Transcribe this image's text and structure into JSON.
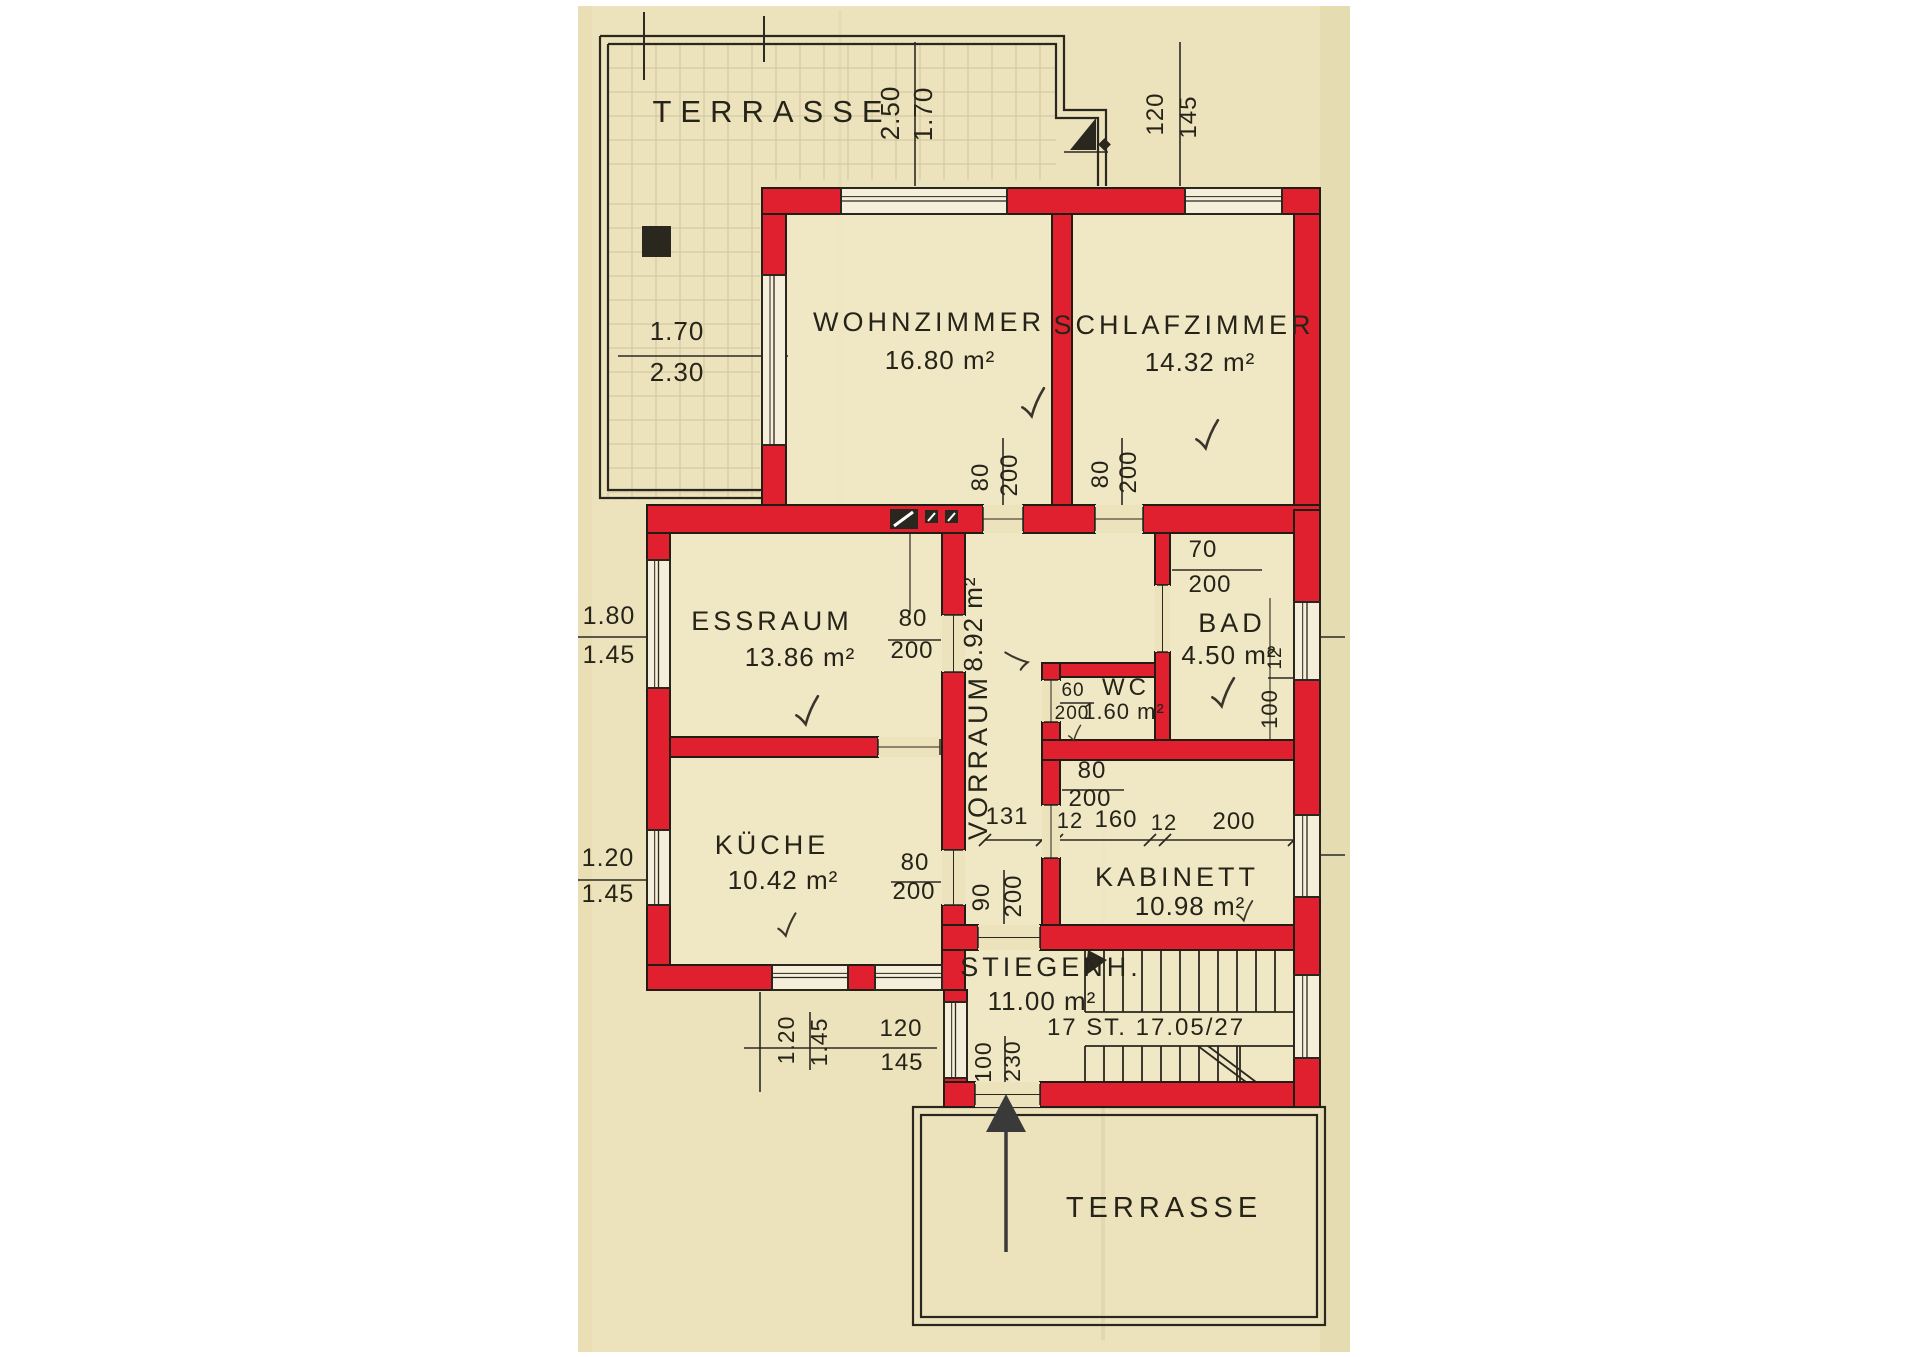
{
  "palette": {
    "paper": "#ece2bb",
    "paper_edge": "#e0d4a6",
    "floor": "#f1e8c8",
    "ink": "#2a271f",
    "wall_red": "#e0202f",
    "wall_outline": "#211d15",
    "grid": "#b4a87e",
    "window_fill": "#f4eeda"
  },
  "rooms": [
    {
      "id": "terrasse-top",
      "name": "TERRASSE",
      "area": "",
      "cx": 772,
      "cy": 122,
      "size": 31,
      "ls": 9
    },
    {
      "id": "wohnzimmer",
      "name": "WOHNZIMMER",
      "area": "16.80 m²",
      "cx": 929,
      "cy": 331,
      "acx": 940,
      "acy": 369
    },
    {
      "id": "schlafzimmer",
      "name": "SCHLAFZIMMER",
      "area": "14.32 m²",
      "cx": 1184,
      "cy": 334,
      "acx": 1200,
      "acy": 371
    },
    {
      "id": "essraum",
      "name": "ESSRAUM",
      "area": "13.86 m²",
      "cx": 772,
      "cy": 630,
      "acx": 800,
      "acy": 666
    },
    {
      "id": "vorraum",
      "name": "VORRAUM",
      "area": "8.92 m²",
      "cx": 987,
      "cy": 757,
      "acx": 982,
      "acy": 624,
      "rot": -90
    },
    {
      "id": "bad",
      "name": "BAD",
      "area": "4.50 m²",
      "cx": 1232,
      "cy": 632,
      "acx": 1229,
      "acy": 664
    },
    {
      "id": "wc",
      "name": "WC",
      "area": "1.60 m²",
      "cx": 1126,
      "cy": 695,
      "acx": 1124,
      "acy": 719,
      "size": 24,
      "asize": 22
    },
    {
      "id": "kueche",
      "name": "KÜCHE",
      "area": "10.42 m²",
      "cx": 772,
      "cy": 854,
      "acx": 783,
      "acy": 889
    },
    {
      "id": "kabinett",
      "name": "KABINETT",
      "area": "10.98 m²",
      "cx": 1177,
      "cy": 886,
      "acx": 1190,
      "acy": 915
    },
    {
      "id": "stiegenhaus",
      "name": "STIEGENH.",
      "area": "11.00 m²",
      "cx": 1051,
      "cy": 976,
      "acx": 1042,
      "acy": 1010,
      "note": "17 ST. 17.05/27",
      "ncx": 1146,
      "ncy": 1035
    },
    {
      "id": "terrasse-bottom",
      "name": "TERRASSE",
      "area": "",
      "cx": 1164,
      "cy": 1217,
      "size": 29,
      "ls": 5
    }
  ],
  "dims": [
    {
      "t": "2.50",
      "x": 899,
      "y": 113,
      "r": -90,
      "s": 26
    },
    {
      "t": "1.70",
      "x": 932,
      "y": 114,
      "r": -90,
      "s": 26
    },
    {
      "t": "120",
      "x": 1163,
      "y": 114,
      "r": -90,
      "s": 24
    },
    {
      "t": "145",
      "x": 1196,
      "y": 117,
      "r": -90,
      "s": 24
    },
    {
      "t": "1.70",
      "x": 677,
      "y": 340,
      "r": 0,
      "s": 26
    },
    {
      "t": "2.30",
      "x": 677,
      "y": 381,
      "r": 0,
      "s": 26
    },
    {
      "t": "80",
      "x": 988,
      "y": 477,
      "r": -90,
      "s": 24
    },
    {
      "t": "200",
      "x": 1017,
      "y": 475,
      "r": -90,
      "s": 24
    },
    {
      "t": "80",
      "x": 1108,
      "y": 474,
      "r": -90,
      "s": 24
    },
    {
      "t": "200",
      "x": 1136,
      "y": 472,
      "r": -90,
      "s": 24
    },
    {
      "t": "70",
      "x": 1203,
      "y": 557,
      "r": 0,
      "s": 24
    },
    {
      "t": "200",
      "x": 1210,
      "y": 592,
      "r": 0,
      "s": 24
    },
    {
      "t": "1.80",
      "x": 609,
      "y": 624,
      "r": 0,
      "s": 25
    },
    {
      "t": "1.45",
      "x": 609,
      "y": 663,
      "r": 0,
      "s": 25
    },
    {
      "t": "80",
      "x": 913,
      "y": 626,
      "r": 0,
      "s": 24
    },
    {
      "t": "200",
      "x": 912,
      "y": 658,
      "r": 0,
      "s": 24
    },
    {
      "t": "60",
      "x": 1073,
      "y": 696,
      "r": 0,
      "s": 19
    },
    {
      "t": "200",
      "x": 1072,
      "y": 719,
      "r": 0,
      "s": 19
    },
    {
      "t": "12",
      "x": 1281,
      "y": 658,
      "r": -90,
      "s": 19
    },
    {
      "t": "100",
      "x": 1277,
      "y": 709,
      "r": -90,
      "s": 22
    },
    {
      "t": "1.20",
      "x": 608,
      "y": 866,
      "r": 0,
      "s": 25
    },
    {
      "t": "1.45",
      "x": 608,
      "y": 902,
      "r": 0,
      "s": 25
    },
    {
      "t": "80",
      "x": 915,
      "y": 870,
      "r": 0,
      "s": 24
    },
    {
      "t": "200",
      "x": 914,
      "y": 899,
      "r": 0,
      "s": 24
    },
    {
      "t": "90",
      "x": 989,
      "y": 897,
      "r": -90,
      "s": 24
    },
    {
      "t": "200",
      "x": 1021,
      "y": 896,
      "r": -90,
      "s": 24
    },
    {
      "t": "80",
      "x": 1092,
      "y": 778,
      "r": 0,
      "s": 24
    },
    {
      "t": "200",
      "x": 1090,
      "y": 806,
      "r": 0,
      "s": 24
    },
    {
      "t": "131",
      "x": 1007,
      "y": 824,
      "r": 0,
      "s": 24
    },
    {
      "t": "12",
      "x": 1070,
      "y": 828,
      "r": 0,
      "s": 22
    },
    {
      "t": "160",
      "x": 1116,
      "y": 827,
      "r": 0,
      "s": 24
    },
    {
      "t": "12",
      "x": 1164,
      "y": 830,
      "r": 0,
      "s": 22
    },
    {
      "t": "200",
      "x": 1234,
      "y": 829,
      "r": 0,
      "s": 24
    },
    {
      "t": "120",
      "x": 901,
      "y": 1036,
      "r": 0,
      "s": 24
    },
    {
      "t": "145",
      "x": 902,
      "y": 1070,
      "r": 0,
      "s": 24
    },
    {
      "t": "1.20",
      "x": 794,
      "y": 1040,
      "r": -90,
      "s": 23
    },
    {
      "t": "1.45",
      "x": 827,
      "y": 1042,
      "r": -90,
      "s": 23
    },
    {
      "t": "100",
      "x": 991,
      "y": 1062,
      "r": -90,
      "s": 23
    },
    {
      "t": "230",
      "x": 1020,
      "y": 1061,
      "r": -90,
      "s": 23
    }
  ],
  "checks": [
    {
      "x": 1032,
      "y": 404,
      "r": -8,
      "sc": 1.0
    },
    {
      "x": 1206,
      "y": 436,
      "r": -8,
      "sc": 1.0
    },
    {
      "x": 806,
      "y": 712,
      "r": -8,
      "sc": 1.0
    },
    {
      "x": 1018,
      "y": 662,
      "r": -98,
      "sc": 0.8
    },
    {
      "x": 1222,
      "y": 694,
      "r": -8,
      "sc": 1.0
    },
    {
      "x": 1074,
      "y": 734,
      "r": -8,
      "sc": 0.55
    },
    {
      "x": 786,
      "y": 926,
      "r": -8,
      "sc": 0.8
    },
    {
      "x": 1244,
      "y": 912,
      "r": -8,
      "sc": 0.7
    }
  ]
}
